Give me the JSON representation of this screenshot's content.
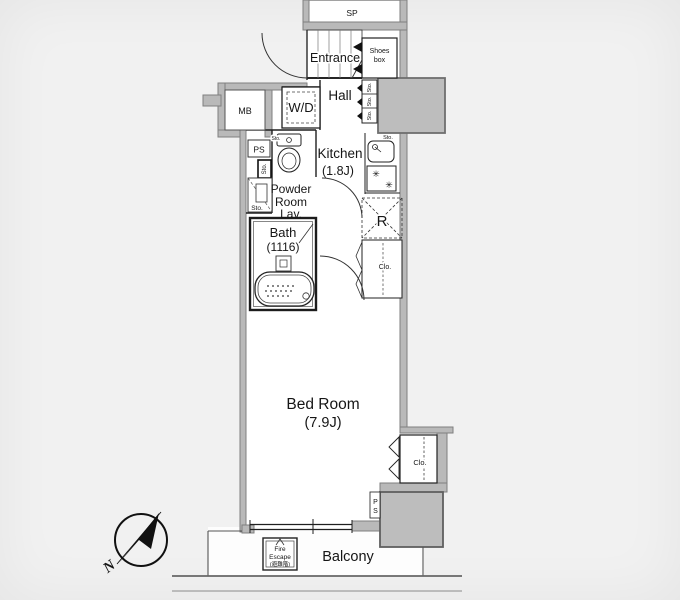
{
  "title": "apartment-floor-plan",
  "colors": {
    "background": "#f1f1f1",
    "paper": "#ffffff",
    "wall_gray": "#b9b9b9",
    "wall_edge": "#7f7f7f",
    "line": "#1f1f1f",
    "needle_black": "#111111"
  },
  "labels": {
    "sp": "SP",
    "entrance": "Entrance",
    "shoes1": "Shoes",
    "shoes2": "box",
    "hall": "Hall",
    "mb": "MB",
    "wd": "W/D",
    "ps": "PS",
    "ps_p": "P",
    "ps_s": "S",
    "sto": "Sto.",
    "kitchen": "Kitchen",
    "kitchen_size": "(1.8J)",
    "powder1": "Powder",
    "powder2": "Room",
    "powder3": "Lav.",
    "bath": "Bath",
    "bath_size": "(1116)",
    "fridge": "R",
    "closet": "Clo.",
    "bedroom": "Bed Room",
    "bedroom_size": "(7.9J)",
    "balcony": "Balcony",
    "fire1": "Fire",
    "fire2": "Escape",
    "fire3": "(避難階)",
    "north": "N"
  },
  "icons": {
    "burner": "✳"
  }
}
